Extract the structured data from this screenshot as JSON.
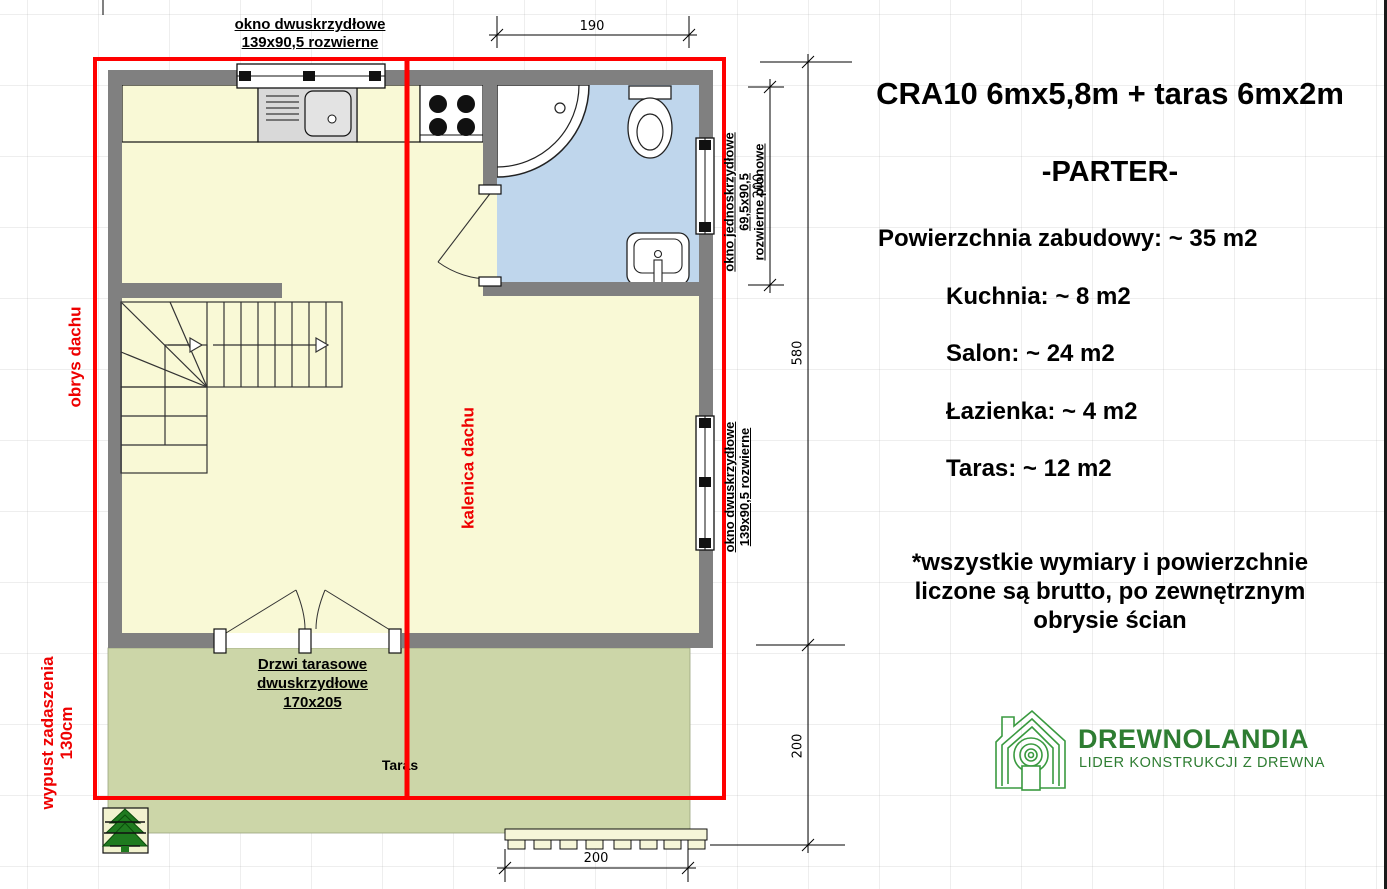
{
  "plan": {
    "top_window_label": {
      "line1": "okno dwuskrzydłowe",
      "line2": "139x90,5 rozwierne"
    },
    "right_window_top_label": {
      "line1": "okno jednoskrzydłowe",
      "line2": "69,5x90,5",
      "line3": "rozwierne pionowe"
    },
    "right_window_bottom_label": {
      "line1": "okno dwuskrzydłowe",
      "line2": "139x90,5 rozwierne"
    },
    "roof_outline_label": "obrys dachu",
    "roof_ridge_label": "kalenica dachu",
    "canopy_label": {
      "line1": "wypust zadaszenia",
      "line2": "130cm"
    },
    "terrace_door_label": {
      "line1": "Drzwi tarasowe",
      "line2": "dwuskrzydłowe",
      "line3": "170x205"
    },
    "terrace_label": "Taras",
    "dims": {
      "top": "190",
      "window_right": "200",
      "house_right": "580",
      "terrace_right": "200",
      "bottom": "200"
    }
  },
  "info": {
    "title": "CRA10 6mx5,8m + taras 6mx2m",
    "floor": "-PARTER-",
    "area_total": "Powierzchnia zabudowy: ~ 35 m2",
    "rooms": [
      "Kuchnia: ~ 8 m2",
      "Salon: ~ 24 m2",
      "Łazienka: ~ 4 m2",
      "Taras: ~ 12 m2"
    ],
    "note_line1": "*wszystkie wymiary i powierzchnie",
    "note_line2": "liczone są brutto, po zewnętrznym",
    "note_line3": "obrysie ścian"
  },
  "logo": {
    "name": "DREWNOLANDIA",
    "tagline": "LIDER KONSTRUKCJI Z DREWNA"
  },
  "colors": {
    "roof_red": "#ff0000",
    "wall_gray": "#808080",
    "floor_yellow": "#f9f9d6",
    "bathroom_blue": "#bfd6ec",
    "terrace_green": "#ccd6a8",
    "logo_green": "#2e7d32"
  }
}
